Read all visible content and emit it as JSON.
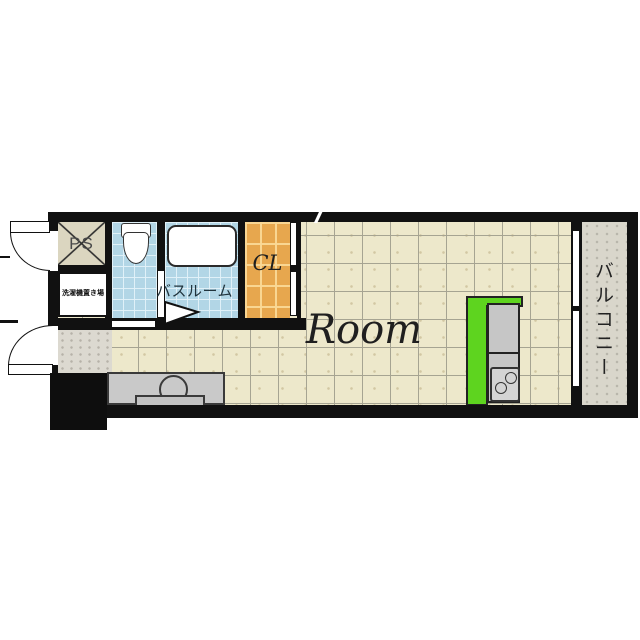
{
  "plan_title": "studio-apartment-floor-plan",
  "rooms": {
    "main": {
      "label": "Room"
    },
    "balcony": {
      "label": "バルコニー"
    },
    "bathroom": {
      "label": "バスルーム"
    },
    "closet": {
      "label": "CL"
    },
    "pipe_shaft": {
      "label": "PS"
    },
    "laundry_space": {
      "label": "洗濯機置き場"
    }
  },
  "fixtures": {
    "toilet": "toilet-with-tank",
    "bathtub": "bathtub",
    "kitchen": "kitchen-counter-with-2-burner-stove",
    "vanity": "sink-counter",
    "entrance": "entrance-step-block",
    "doors": "two-outward-swing-doors-left-wall",
    "window": "sliding-window-to-balcony"
  },
  "colors": {
    "wall": "#111111",
    "room_floor": "#ede8cb",
    "floor_grid_line": "#a6a492",
    "wet_area_floor": "#b2d6e6",
    "closet_floor": "#e7a74e",
    "kitchen_counter_green": "#5ed41f",
    "balcony_floor": "#d9d6cb",
    "hallway_floor": "#dcd9d0",
    "furniture_gray": "#c6c6c6"
  }
}
